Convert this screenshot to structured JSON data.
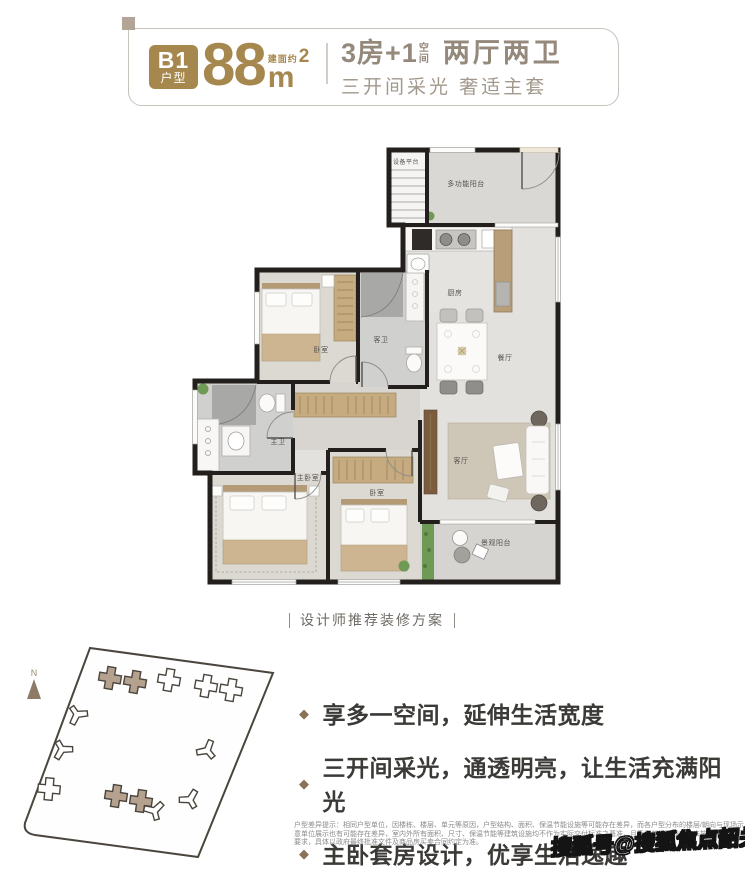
{
  "header": {
    "badge": {
      "code": "B1",
      "type_label": "户型"
    },
    "area": {
      "prefix": "建面约",
      "number": "88",
      "unit": "m",
      "sup": "2"
    },
    "title": {
      "rooms": "3房+1",
      "stack_top": "空",
      "stack_bottom": "间",
      "halls": "两厅两卫"
    },
    "subtitle": "三开间采光 奢适主套"
  },
  "floorplan": {
    "caption": "设计师推荐装修方案",
    "rooms": [
      {
        "name": "equipment-platform",
        "label": "设备平台"
      },
      {
        "name": "multi-balcony",
        "label": "多功能阳台"
      },
      {
        "name": "kitchen",
        "label": "厨房"
      },
      {
        "name": "dining",
        "label": "餐厅"
      },
      {
        "name": "bedroom-top",
        "label": "卧室"
      },
      {
        "name": "guest-bath",
        "label": "客卫"
      },
      {
        "name": "master-bath",
        "label": "主卫"
      },
      {
        "name": "master-bedroom",
        "label": "主卧室"
      },
      {
        "name": "bedroom-2",
        "label": "卧室"
      },
      {
        "name": "living",
        "label": "客厅"
      },
      {
        "name": "view-balcony",
        "label": "景观阳台"
      }
    ]
  },
  "siteplan": {
    "compass": "N"
  },
  "selling_points": [
    "享多一空间，延伸生活宽度",
    "三开间采光，通透明亮，让生活充满阳光",
    "主卧套房设计，优享生活逸趣"
  ],
  "disclaimer": "户型差异提示：相同户型单位，因楼栋、楼层、单元等原因，户型结构、面积、保温节能设施等可能存在差异，而各户型分布的楼层/朝向与现场示意单位展示也有可能存在差异，室内外所有面积、尺寸、保温节能等建筑设施均不作为实际交付标准之基准，且示意单位可能存在未按保温节能等要求，具体以政府最终批准文件及商品房买卖合同约定为准。",
  "watermark": "搜狐号@搜狐焦点韶关站",
  "colors": {
    "gold": "#a6874e",
    "taupe": "#95897c",
    "highlight": "#b5a28e",
    "wall": "#221f1c",
    "diamond": "#8a7157"
  }
}
